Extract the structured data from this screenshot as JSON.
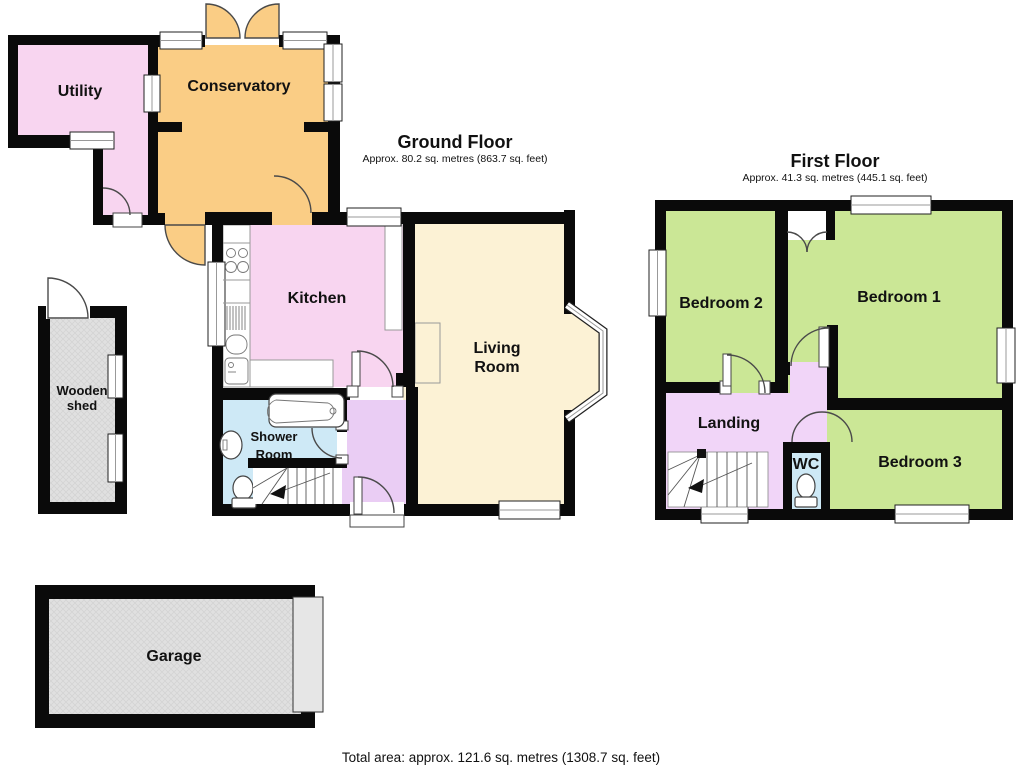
{
  "colors": {
    "wall_black": "#0a0a0a",
    "room_pink": "#F8D5F0",
    "conservatory_orange": "#FACD85",
    "living_cream": "#FCF2D5",
    "bath_blue": "#CEE9F6",
    "hall_lavender": "#EACDF4",
    "landing_lavender": "#F1D5F8",
    "bedroom_green": "#CBE796",
    "outbuilding_gray": "#E0E0E0",
    "outbuilding_hatch": "#CFCFCF",
    "door_arc": "#4a4a4a",
    "counter_line": "#999999"
  },
  "ground_floor": {
    "title": "Ground Floor",
    "subtitle": "Approx. 80.2 sq. metres (863.7 sq. feet)",
    "rooms": {
      "utility": "Utility",
      "conservatory": "Conservatory",
      "kitchen": "Kitchen",
      "living_line1": "Living",
      "living_line2": "Room",
      "shower_line1": "Shower",
      "shower_line2": "Room"
    }
  },
  "first_floor": {
    "title": "First Floor",
    "subtitle": "Approx. 41.3 sq. metres (445.1 sq. feet)",
    "rooms": {
      "bedroom1": "Bedroom 1",
      "bedroom2": "Bedroom 2",
      "bedroom3": "Bedroom 3",
      "landing": "Landing",
      "wc": "WC"
    }
  },
  "outbuildings": {
    "shed_line1": "Wooden",
    "shed_line2": "shed",
    "garage": "Garage"
  },
  "footer": {
    "total_area": "Total area: approx. 121.6 sq. metres (1308.7 sq. feet)"
  }
}
